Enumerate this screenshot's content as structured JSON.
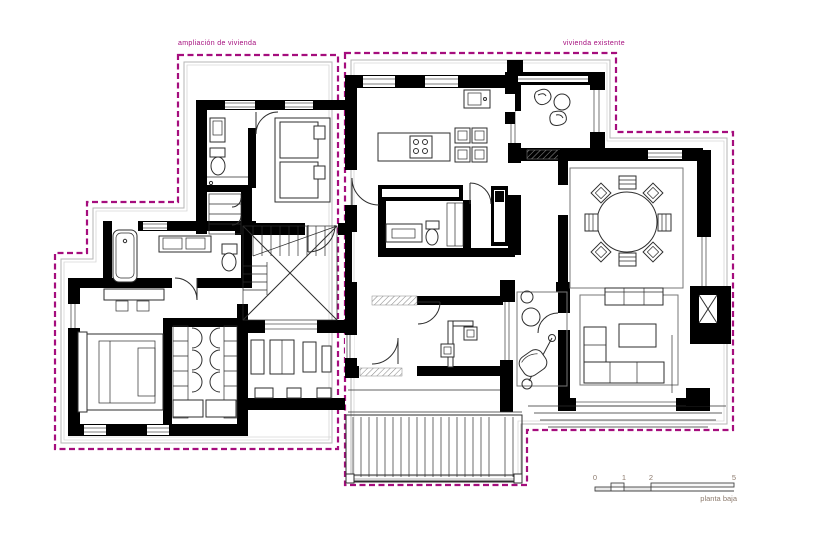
{
  "labels": {
    "left_region": "ampliación de vivienda",
    "right_region": "vivienda existente",
    "plan_name": "planta baja"
  },
  "scale_bar": {
    "ticks": [
      "0",
      "1",
      "2",
      "5"
    ]
  },
  "colors": {
    "boundary": "#a50d7d",
    "walls": "#000000",
    "furniture": "#2e2e2e",
    "site": "#b5b5b5",
    "scale_text": "#8d7b6e"
  }
}
